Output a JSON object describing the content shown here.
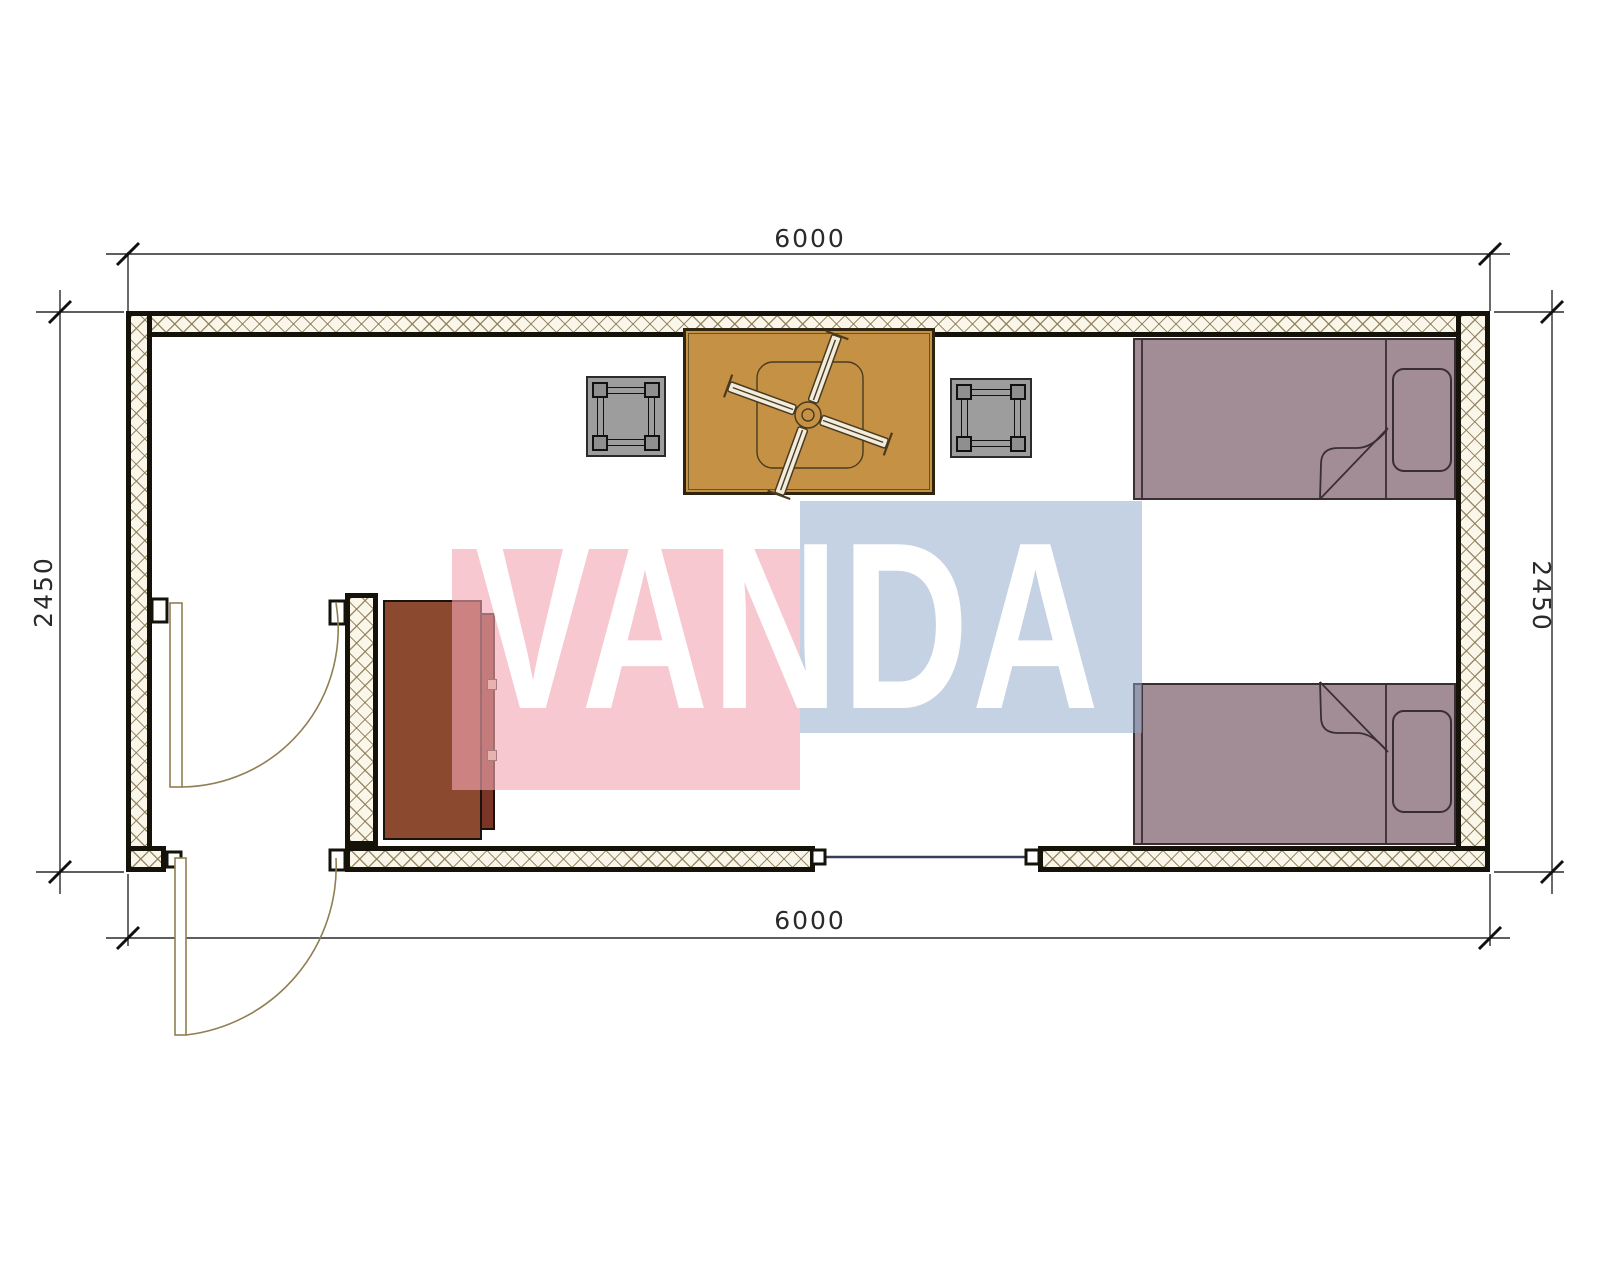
{
  "title": "container-house-floor-plan",
  "dimensions": {
    "top": "6000",
    "bottom": "6000",
    "left": "2450",
    "right": "2450"
  },
  "watermark": {
    "text": "VANDA"
  },
  "furniture": [
    {
      "name": "dining-table"
    },
    {
      "name": "ceiling-fan"
    },
    {
      "name": "stool-left"
    },
    {
      "name": "stool-right"
    },
    {
      "name": "single-bed-top"
    },
    {
      "name": "single-bed-bottom"
    },
    {
      "name": "cabinet"
    }
  ],
  "openings": [
    {
      "name": "interior-door"
    },
    {
      "name": "entry-door"
    },
    {
      "name": "window"
    }
  ],
  "colors": {
    "table": "#C59144",
    "table_border": "#2E2410",
    "stool": "#9D9D9D",
    "stool_leg": "#8F8F8F",
    "bed": "#A28C95",
    "bed_line": "#3A2E35",
    "cabinet": "#8B4930",
    "cabinet_door": "#7A3527",
    "handle": "#D8C8A8",
    "wall_fill": "#FAF6EA",
    "wall_hatch": "#8A7A55",
    "wall_border": "#15120A",
    "door_line": "#8F7F52",
    "window_line": "#383D5E",
    "dim": "#2A2A2A",
    "watermark_pink": "rgba(242,166,177,0.62)",
    "watermark_blue": "rgba(140,165,200,0.5)",
    "watermark_text": "#FFFFFF"
  }
}
